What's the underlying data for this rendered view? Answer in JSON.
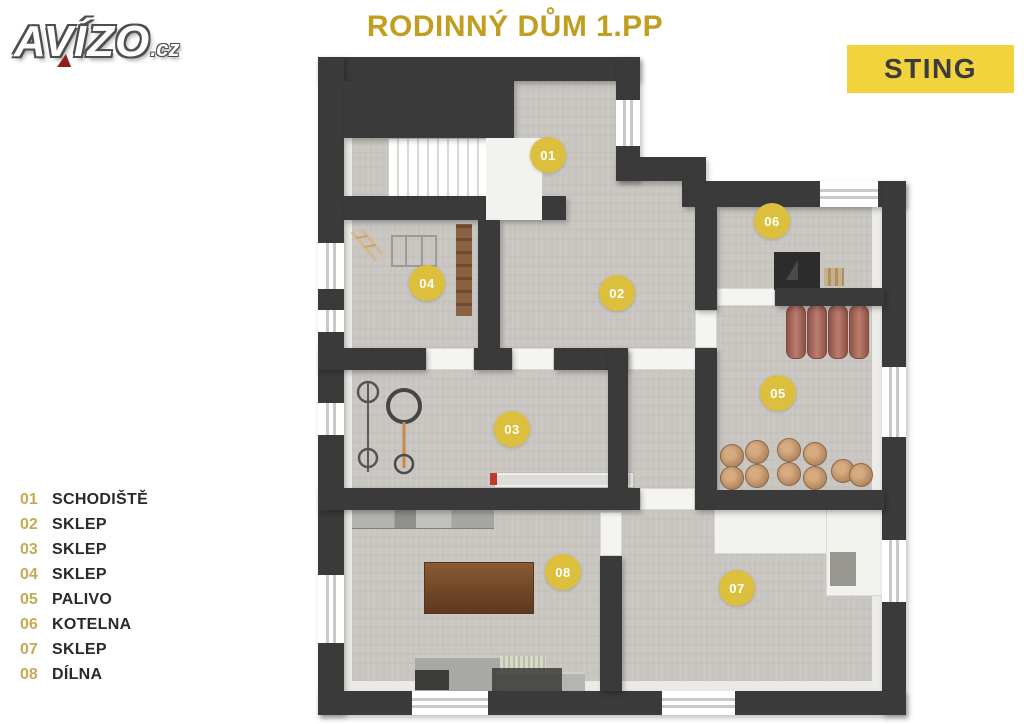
{
  "header": {
    "logo_text": "AVÍZO",
    "logo_suffix": ".cz",
    "title": "RODINNÝ DŮM 1.PP",
    "brand": "STING"
  },
  "legend": [
    {
      "num": "01",
      "label": "SCHODIŠTĚ"
    },
    {
      "num": "02",
      "label": "SKLEP"
    },
    {
      "num": "03",
      "label": "SKLEP"
    },
    {
      "num": "04",
      "label": "SKLEP"
    },
    {
      "num": "05",
      "label": "PALIVO"
    },
    {
      "num": "06",
      "label": "KOTELNA"
    },
    {
      "num": "07",
      "label": "SKLEP"
    },
    {
      "num": "08",
      "label": "DÍLNA"
    }
  ],
  "floorplan": {
    "badges": [
      {
        "num": "01",
        "room": "SCHODIŠTĚ",
        "x": 548,
        "y": 155
      },
      {
        "num": "02",
        "room": "SKLEP",
        "x": 617,
        "y": 293
      },
      {
        "num": "03",
        "room": "SKLEP",
        "x": 512,
        "y": 429
      },
      {
        "num": "04",
        "room": "SKLEP",
        "x": 427,
        "y": 283
      },
      {
        "num": "05",
        "room": "PALIVO",
        "x": 778,
        "y": 393
      },
      {
        "num": "06",
        "room": "KOTELNA",
        "x": 772,
        "y": 221
      },
      {
        "num": "07",
        "room": "SKLEP",
        "x": 737,
        "y": 588
      },
      {
        "num": "08",
        "room": "DÍLNA",
        "x": 563,
        "y": 572
      }
    ]
  },
  "colors": {
    "title_gold": "#c19e20",
    "sting_bg": "#f2d23d",
    "badge_yellow": "#dcbf3c",
    "wall_dark": "#3a3a3a",
    "floor_gray": "#c9c6c1",
    "legend_number": "#c3ab54",
    "logo_red": "#8f1d1d"
  }
}
